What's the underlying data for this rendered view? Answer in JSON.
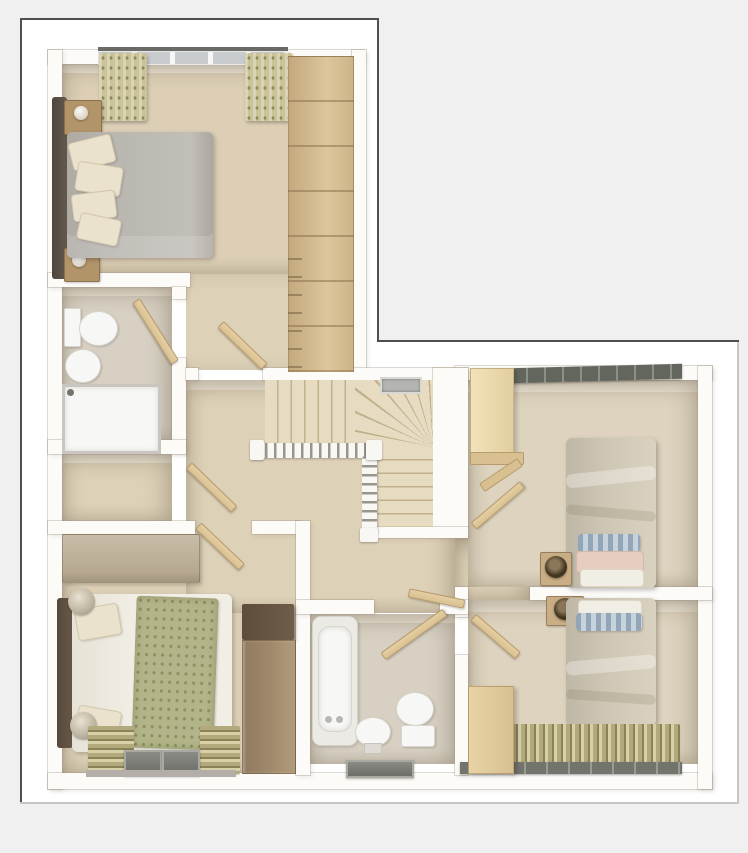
{
  "title": "3D first-floor plan render",
  "colors": {
    "page_bg": "#f0f0f1",
    "frame_dark": "#4f4f4f",
    "frame_light": "#c6c6c6",
    "margin_white": "#ffffff",
    "wall": "#fcfbf8",
    "wallface": "#ece5d6",
    "floor_bedroom": "#dccfb6",
    "floor_hall": "#ddd1b8",
    "floor_bath": "#d8d1c3",
    "floor_right": "#ddd3be",
    "stair_tread": "#e7dbc2",
    "stair_line": "#c3b18e",
    "rail_white": "#f8f7f4",
    "baluster": "#9a948a",
    "door_tan": "#d8c091",
    "door_tan_dark": "#b89a6c",
    "wardrobe_oak": "#d0b88d",
    "wardrobe_oak_line": "#a98f66",
    "wardrobe_cream": "#f2e2ba",
    "wardrobe_brown": "#a18a6b",
    "wardrobe_brown_cap": "#6f5d4a",
    "headboard_dark": "#645a4d",
    "mattress_gray": "#b9b5af",
    "pillow_cream": "#eae2cd",
    "duvet_white": "#f1eee5",
    "throw_green": "#b2b489",
    "throw_green_dot": "#8e905f",
    "duvet_taupe": "#cfc7b5",
    "pillow_blue": "#93a6b7",
    "pillow_pink": "#e6cdbf",
    "rug_olive": "#b2aa7d",
    "rug_olive_dark": "#8b8258",
    "rug_cream": "#d8d1a8",
    "window_glass": "#c8ccce",
    "window_dark": "#63665c",
    "curtain": "#cbc398",
    "curtain_dot": "#8f8a60",
    "fixture": "#f7f7f5",
    "fixture_edge": "#d9d6cf",
    "wood_cab": "#b29469",
    "lamp_dark": "#41351f",
    "vent_gray": "#b5b5b1",
    "dresser": "#c9bda8",
    "sill_gray": "#b3afa8"
  },
  "rooms": [
    {
      "name": "master-bedroom",
      "furniture": [
        "double-bed",
        "headboard",
        "bedside-cabinet",
        "bedside-cabinet",
        "table-lamp",
        "table-lamp",
        "fitted-wardrobes",
        "window",
        "curtains"
      ]
    },
    {
      "name": "ensuite-bathroom",
      "furniture": [
        "toilet",
        "basin",
        "shower-enclosure",
        "door"
      ]
    },
    {
      "name": "airing-cupboard",
      "furniture": [
        "door"
      ]
    },
    {
      "name": "bedroom-2",
      "furniture": [
        "double-bed",
        "dresser",
        "wardrobe",
        "table-lamp",
        "table-lamp",
        "rug",
        "rug",
        "windows"
      ]
    },
    {
      "name": "landing",
      "furniture": [
        "staircase",
        "winder-steps",
        "balustrade",
        "vent",
        "doors"
      ]
    },
    {
      "name": "bedroom-3",
      "furniture": [
        "single-bed",
        "bedside-table",
        "table-lamp",
        "cream-wardrobe",
        "shelf",
        "window"
      ]
    },
    {
      "name": "bedroom-4",
      "furniture": [
        "single-bed",
        "bedside-table",
        "table-lamp",
        "wardrobe",
        "rug",
        "window"
      ]
    },
    {
      "name": "family-bathroom",
      "furniture": [
        "bathtub",
        "toilet",
        "pedestal-basin",
        "window",
        "door"
      ]
    }
  ]
}
